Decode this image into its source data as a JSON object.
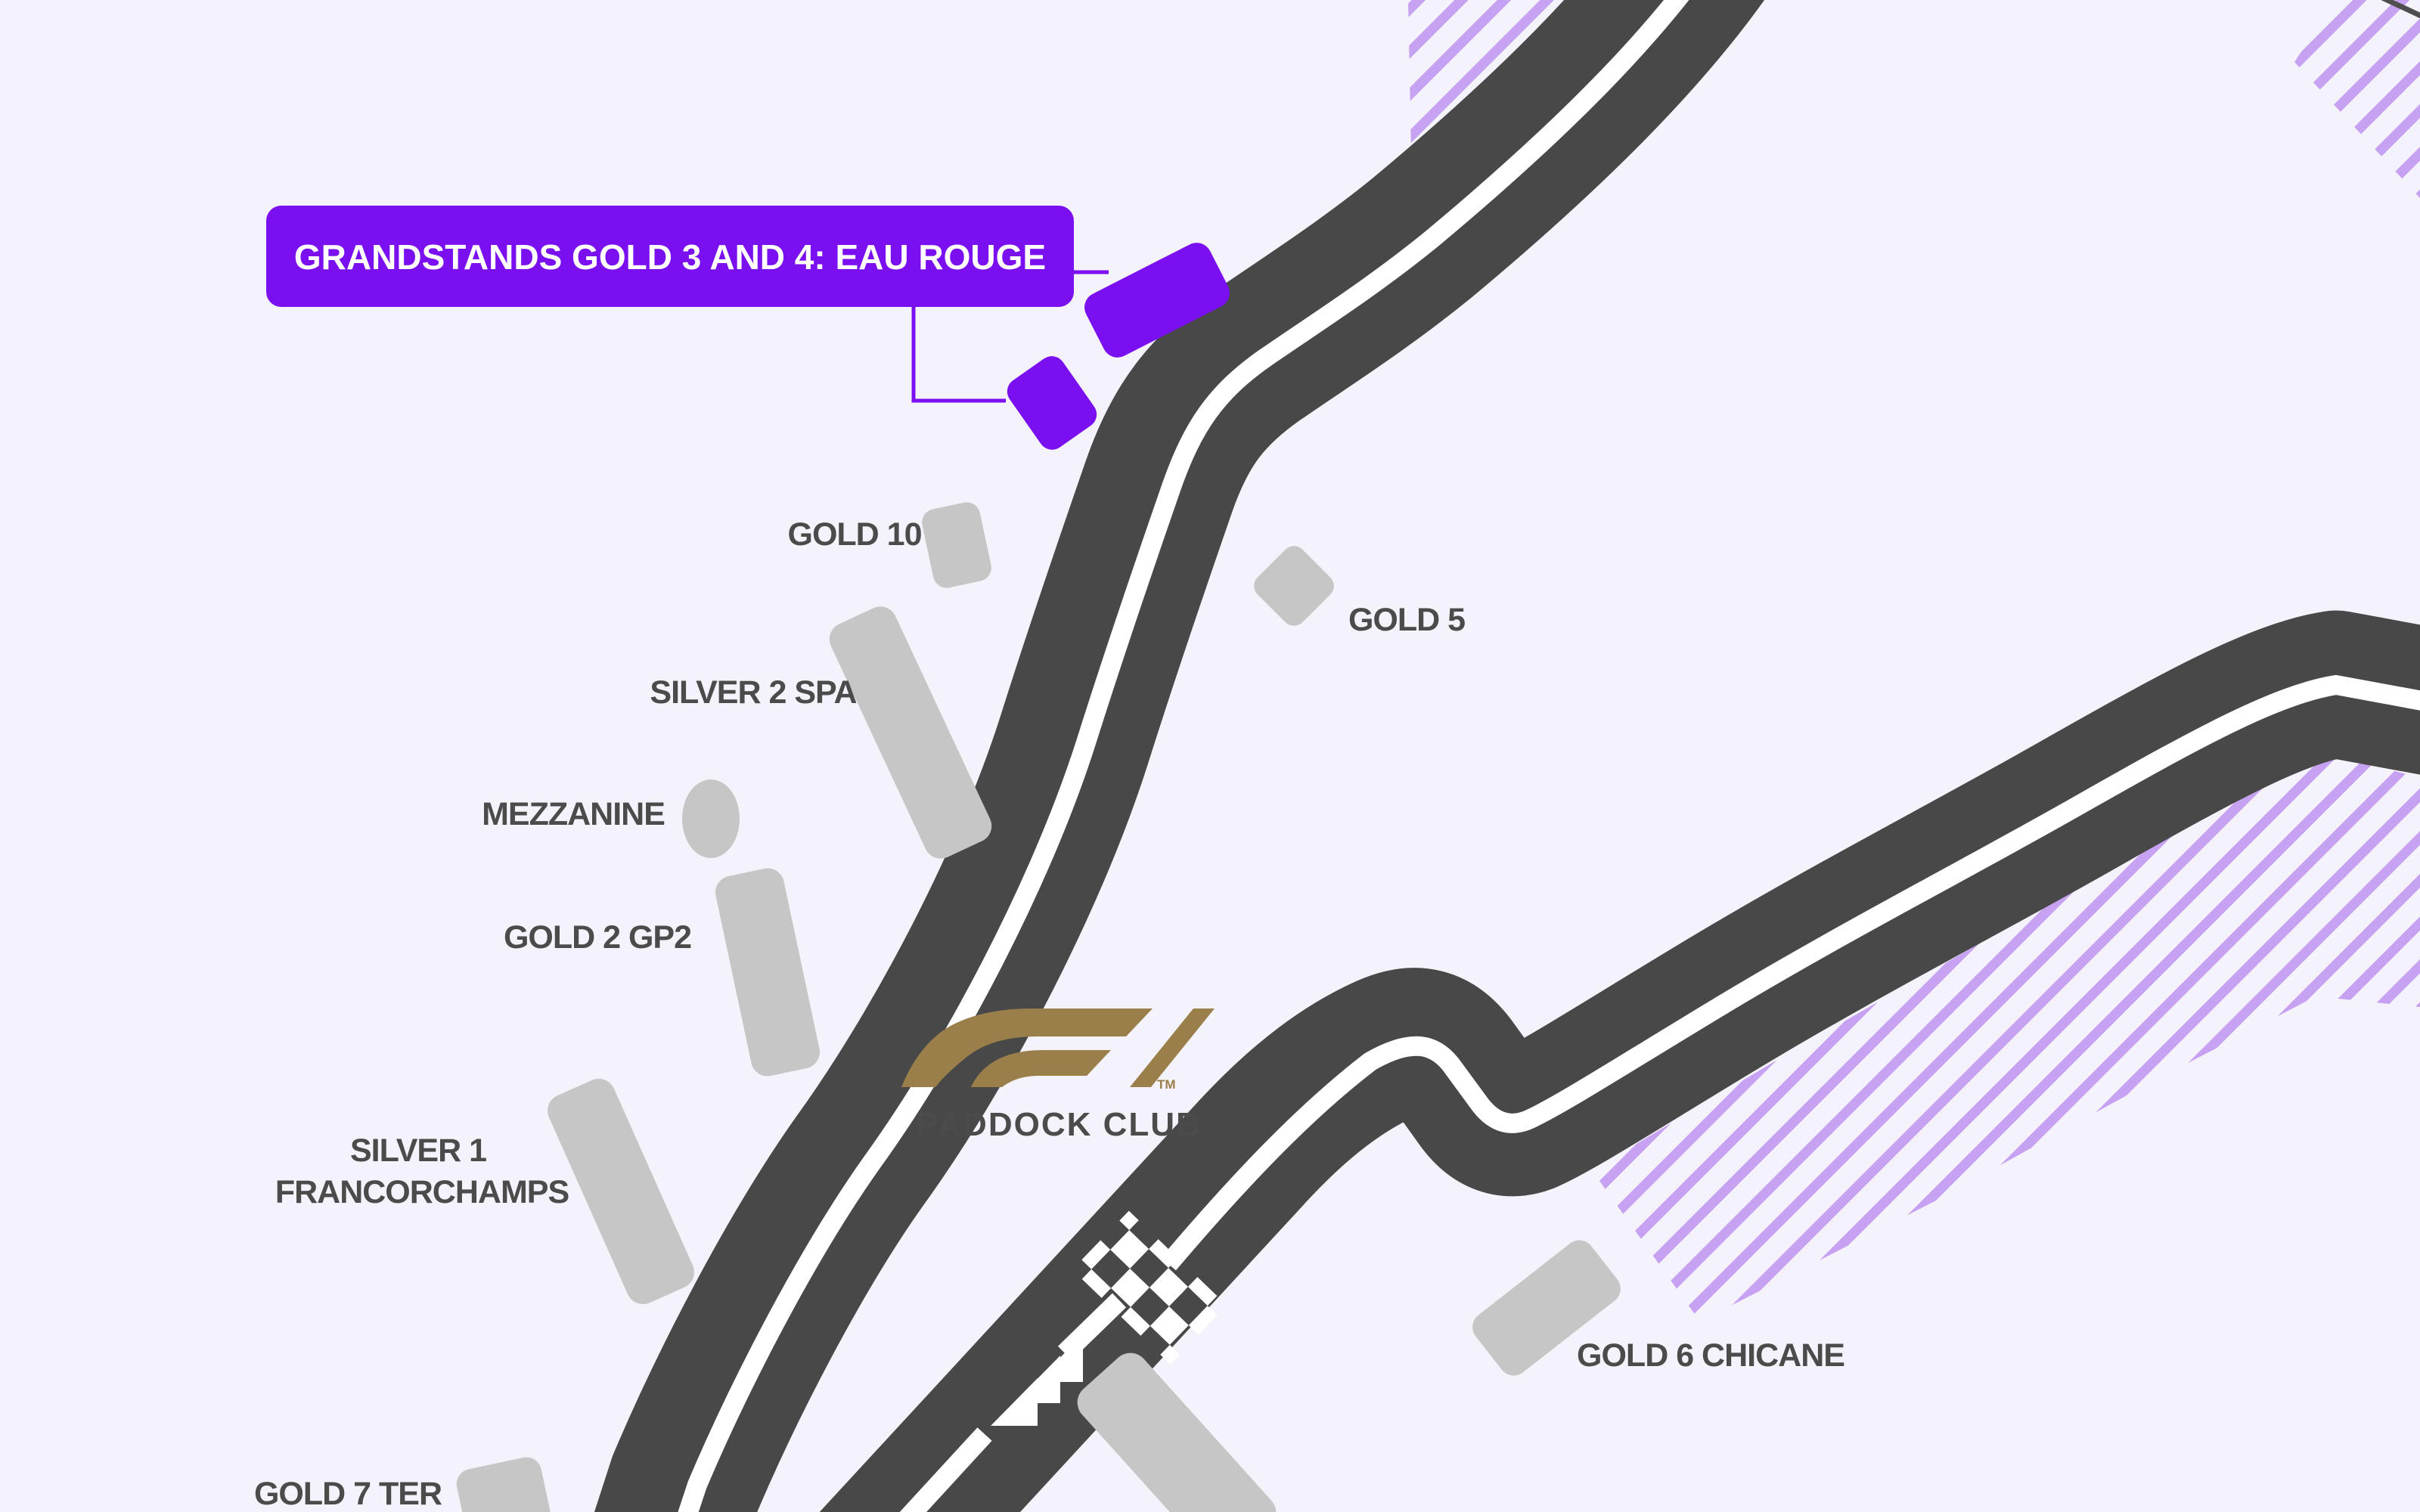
{
  "map": {
    "title_context": "circuit-grandstand-map",
    "callout": {
      "label": "GRANDSTANDS GOLD 3 AND 4: EAU ROUGE"
    },
    "grandstands": {
      "gold10": {
        "label": "GOLD 10"
      },
      "gold5": {
        "label": "GOLD 5"
      },
      "silver2": {
        "label": "SILVER 2 SPA"
      },
      "mezzanine": {
        "label": "MEZZANINE"
      },
      "gold2": {
        "label": "GOLD 2 GP2"
      },
      "silver1": {
        "label_line1": "SILVER 1",
        "label_line2": "FRANCORCHAMPS"
      },
      "gold7ter": {
        "label": "GOLD 7 TER"
      },
      "gold6": {
        "label": "GOLD 6 CHICANE"
      }
    },
    "paddock_club": {
      "label": "PADDOCK CLUB",
      "logo": "F1",
      "trademark": "TM"
    },
    "colors": {
      "background": "#f4f2fa",
      "track": "#484848",
      "track_line": "#ffffff",
      "grandstand_gray": "#c6c6c6",
      "label_gray": "#4b4b4b",
      "highlight_purple": "#7a0ff0",
      "hatch_purple": "#c7a2f2",
      "f1_gold": "#9a7f4b"
    }
  }
}
